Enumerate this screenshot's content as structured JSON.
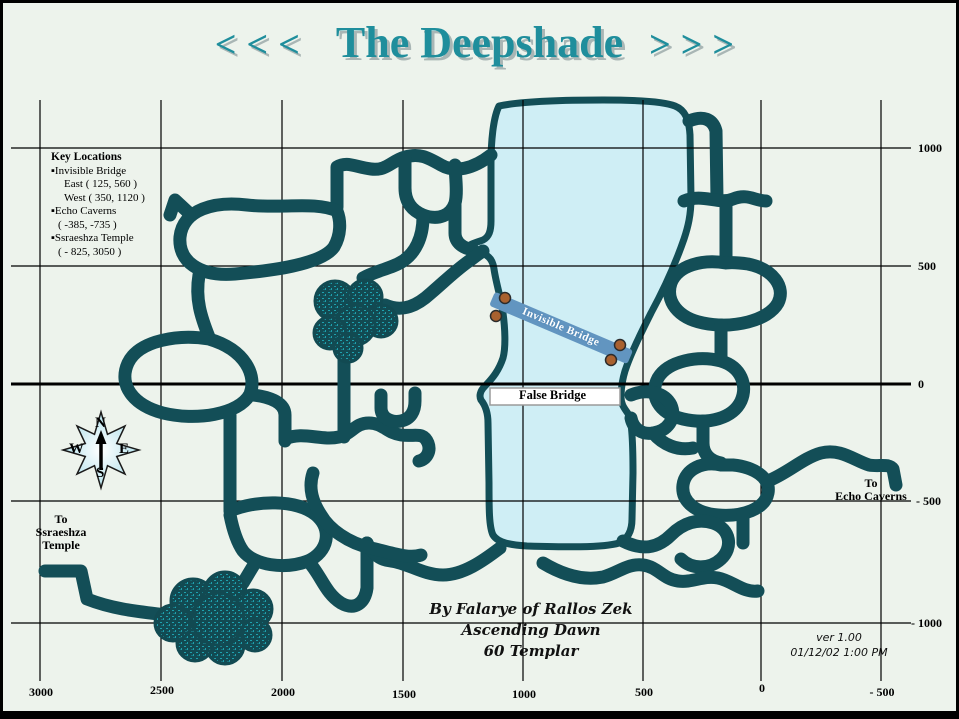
{
  "title": {
    "left": "<<<",
    "text": "The Deepshade",
    "right": ">>>"
  },
  "key_locations": {
    "title": "Key Locations",
    "lines": [
      "▪Invisible Bridge",
      "East  ( 125, 560 )",
      "West  ( 350, 1120 )",
      "▪Echo Caverns",
      "( -385, -735 )",
      "▪Ssraeshza Temple",
      "( - 825, 3050 )"
    ]
  },
  "labels": {
    "false_bridge": "False Bridge",
    "invisible_bridge": "Invisible Bridge",
    "to_ssraeshza": [
      "To",
      "Ssraeshza",
      "Temple"
    ],
    "to_echo": [
      "To",
      "Echo Caverns"
    ]
  },
  "compass": {
    "n": "N",
    "e": "E",
    "s": "S",
    "w": "W"
  },
  "credits": {
    "line1": "By  Falarye of Rallos Zek",
    "line2": "Ascending Dawn",
    "line3": "60 Templar"
  },
  "version": {
    "line1": "ver 1.00",
    "line2": "01/12/02 1:00 PM"
  },
  "axes": {
    "right": [
      "1000",
      "500",
      "0",
      "- 500",
      "- 1000"
    ],
    "bottom": [
      "3000",
      "2500",
      "2000",
      "1500",
      "1000",
      "500",
      "0",
      "- 500"
    ]
  },
  "colors": {
    "background": "#edf3ec",
    "title_teal": "#1f8e9c",
    "tunnel": "#134e57",
    "lake_fill": "#cfeef5",
    "bridge_band": "#6295c0",
    "bridge_dot": "#a9612f",
    "grid": "#000000"
  }
}
